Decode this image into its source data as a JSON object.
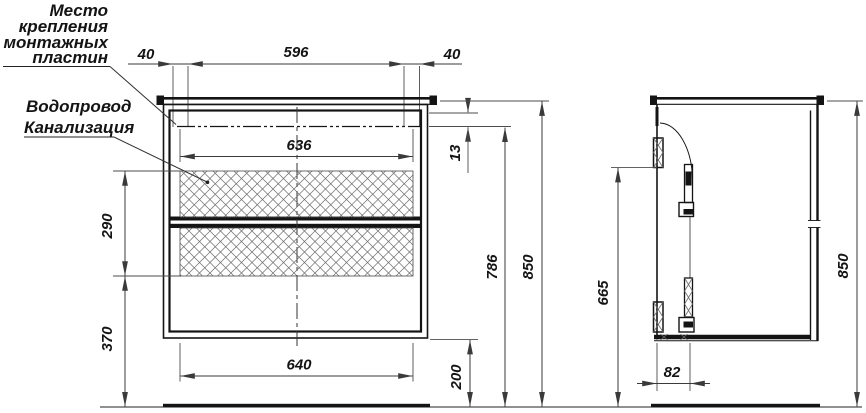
{
  "notes": {
    "mounting": {
      "line1": "Место",
      "line2": "крепления",
      "line3": "монтажных",
      "line4": "пластин"
    },
    "plumbing": {
      "line1": "Водопровод",
      "line2": "Канализация"
    }
  },
  "front_view": {
    "dims": {
      "margin_left": "40",
      "plates_span": "596",
      "margin_right": "40",
      "pipe_zone_width": "636",
      "pipe_offset": "13",
      "drawer_zone_height": "290",
      "zone_to_floor": "370",
      "pipe_line_height": "786",
      "total_height": "850",
      "bottom_width": "640",
      "floor_clearance": "200"
    }
  },
  "side_view": {
    "dims": {
      "plate_bottom_height": "665",
      "plate_depth": "82",
      "total_height": "850"
    }
  },
  "colors": {
    "background": "#ffffff",
    "line": "#141414",
    "dim_line": "#3a3a3a",
    "extension_line": "#4d4d4d",
    "hatch": "#6b6b6b"
  }
}
